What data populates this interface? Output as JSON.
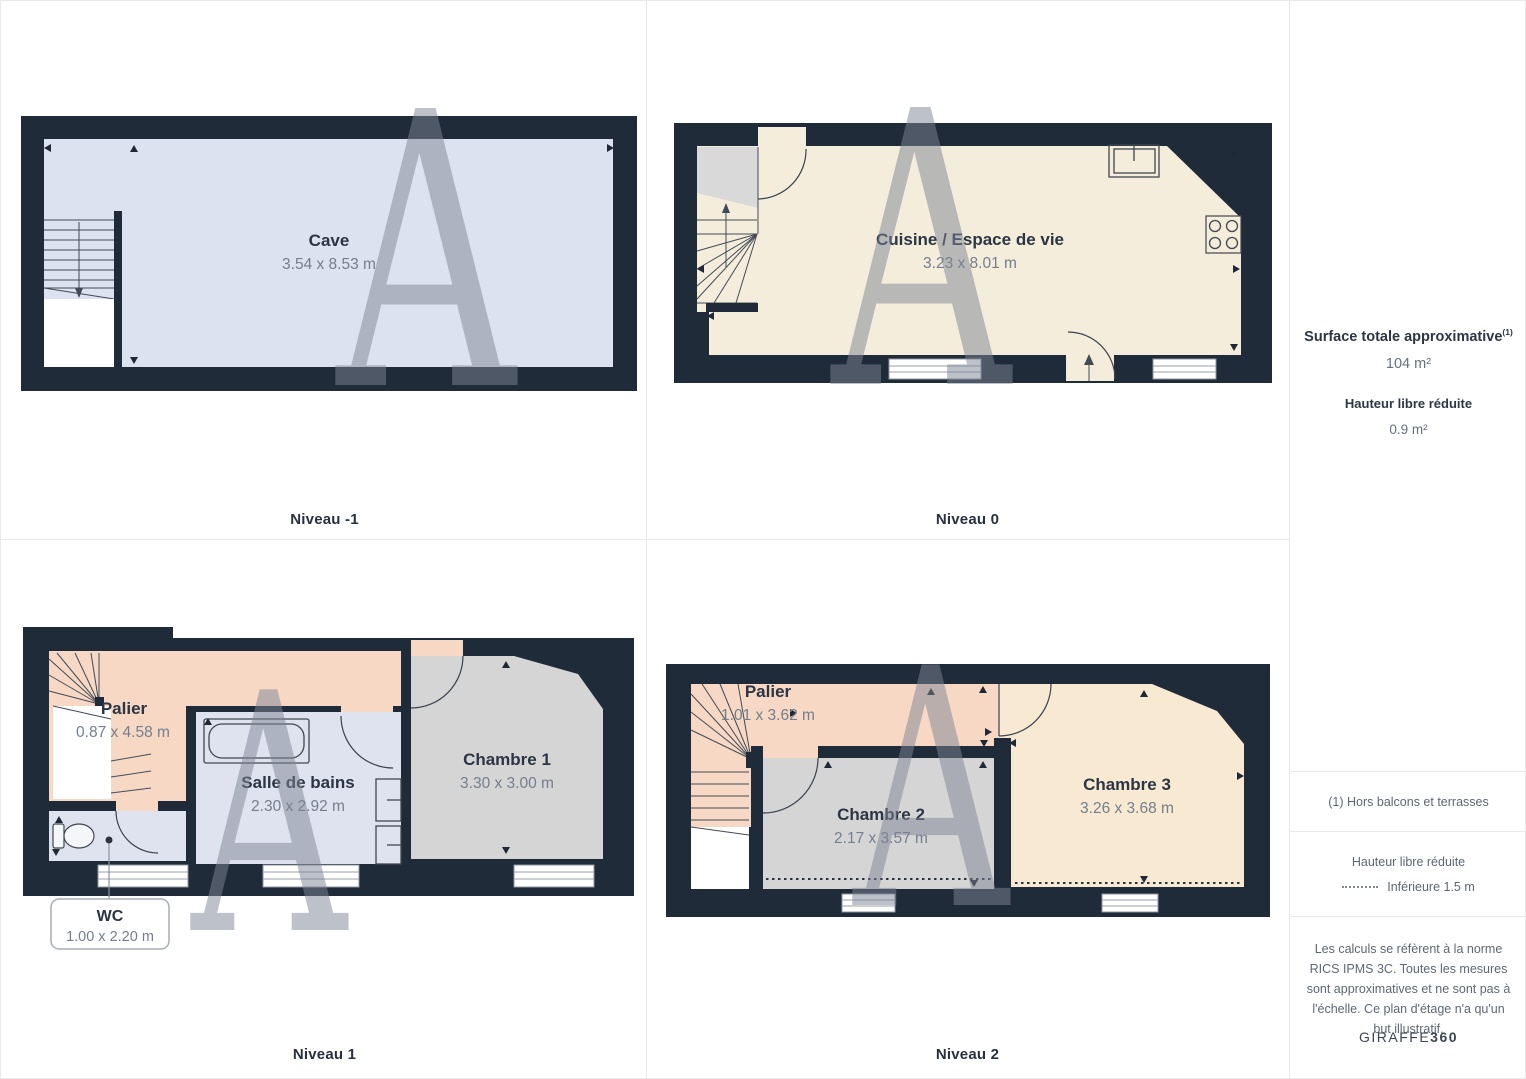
{
  "watermark": {
    "letter": "A"
  },
  "colors": {
    "wall": "#202b3a",
    "cave_floor": "#dce3f0",
    "kitchen_floor": "#f4eddb",
    "landing_floor": "#f6d8c5",
    "bathroom_floor": "#dfe3ef",
    "bedroom_gray_floor": "#d5d5d6",
    "bedroom_cream_floor": "#f8e9d3",
    "accent_text": "#2c3544",
    "dim_text": "#747e8d"
  },
  "plans": [
    {
      "id": "niveau-m1",
      "level_label": "Niveau -1",
      "rooms": [
        {
          "name": "Cave",
          "dimensions": "3.54 x 8.53 m"
        }
      ]
    },
    {
      "id": "niveau-0",
      "level_label": "Niveau 0",
      "rooms": [
        {
          "name": "Cuisine / Espace de vie",
          "dimensions": "3.23 x 8.01 m"
        }
      ]
    },
    {
      "id": "niveau-1",
      "level_label": "Niveau 1",
      "rooms": [
        {
          "name": "Palier",
          "dimensions": "0.87 x 4.58 m"
        },
        {
          "name": "Salle de bains",
          "dimensions": "2.30 x 2.92 m"
        },
        {
          "name": "Chambre 1",
          "dimensions": "3.30 x 3.00 m"
        },
        {
          "name": "WC",
          "dimensions": "1.00 x 2.20 m"
        }
      ]
    },
    {
      "id": "niveau-2",
      "level_label": "Niveau 2",
      "rooms": [
        {
          "name": "Palier",
          "dimensions": "1.01 x 3.62 m"
        },
        {
          "name": "Chambre 2",
          "dimensions": "2.17 x 3.57 m"
        },
        {
          "name": "Chambre 3",
          "dimensions": "3.26 x 3.68 m"
        }
      ]
    }
  ],
  "sidebar": {
    "surface_title": "Surface totale approximative",
    "surface_superscript": "(1)",
    "surface_value": "104 m²",
    "reduced_height_title": "Hauteur libre réduite",
    "reduced_height_value": "0.9 m²",
    "footnote": "(1) Hors balcons et terrasses",
    "legend_title": "Hauteur libre réduite",
    "legend_value": "Inférieure 1.5 m",
    "disclaimer": "Les calculs se réfèrent à la norme RICS IPMS 3C. Toutes les mesures sont approximatives et ne sont pas à l'échelle. Ce plan d'étage n'a qu'un but illustratif.",
    "brand_regular": "GIRAFFE",
    "brand_bold": "360"
  }
}
